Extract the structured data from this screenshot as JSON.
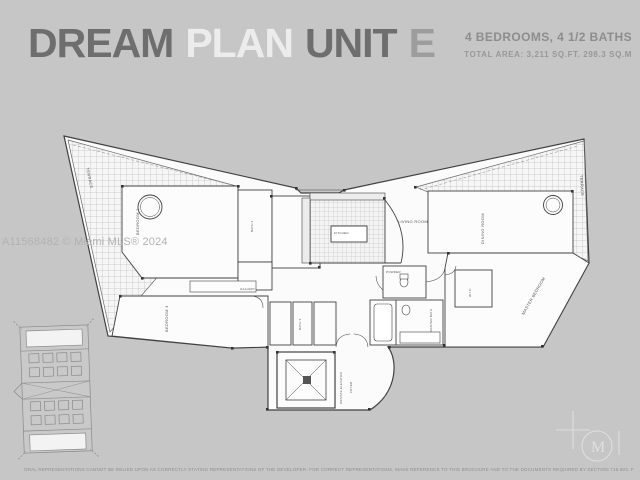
{
  "colors": {
    "background": "#c6c6c6",
    "title_dark": "#6e6e6e",
    "title_light": "#ececec",
    "title_mid": "#9d9d9d",
    "specs_text": "#8d8d8d",
    "plan_lines": "#414141",
    "watermark_text": "#b2b2b2",
    "logo": "#dfdfdf"
  },
  "header": {
    "words": [
      {
        "text": "DREAM"
      },
      {
        "text": "PLAN"
      },
      {
        "text": "UNIT"
      },
      {
        "text": "E"
      }
    ],
    "specs_line1": "4 BEDROOMS, 4 1/2 BATHS",
    "specs_line2": "TOTAL AREA: 3,211 SQ.FT. 298.3 SQ.M"
  },
  "watermark": "A11568482 © Miami MLS® 2024",
  "floorplan": {
    "labels": {
      "terrace_left": "TERRACE",
      "terrace_right": "TERRACE",
      "bedroom2": "BEDROOM 2",
      "bedroom3": "BEDROOM 3",
      "bath2": "BATH 2",
      "bath3": "BATH 3",
      "kitchen": "KITCHEN",
      "gallery": "GALLERY",
      "living_room": "LIVING ROOM",
      "dining_room": "DINING ROOM",
      "master_bedroom": "MASTER BEDROOM",
      "master_bath": "MASTER BATH",
      "wic": "W.I.C.",
      "powder": "POWDER",
      "foyer": "FOYER",
      "elevator": "PRIVATE ELEVATOR"
    }
  },
  "logo": {
    "monogram": "M"
  },
  "footer": {
    "disclaimer": "ORAL REPRESENTATIONS CANNOT BE RELIED UPON AS CORRECTLY STATING REPRESENTATIONS OF THE DEVELOPER. FOR CORRECT REPRESENTATIONS, MAKE REFERENCE TO THIS BROCHURE AND TO THE DOCUMENTS REQUIRED BY SECTION 718.503, FLORIDA STATUTES, TO BE FURNISHED BY A DEVELOPER TO A BUYER OR LESSEE. ALL DIMENSIONS ARE APPROXIMATE AND SUBJECT TO CHANGE."
  }
}
